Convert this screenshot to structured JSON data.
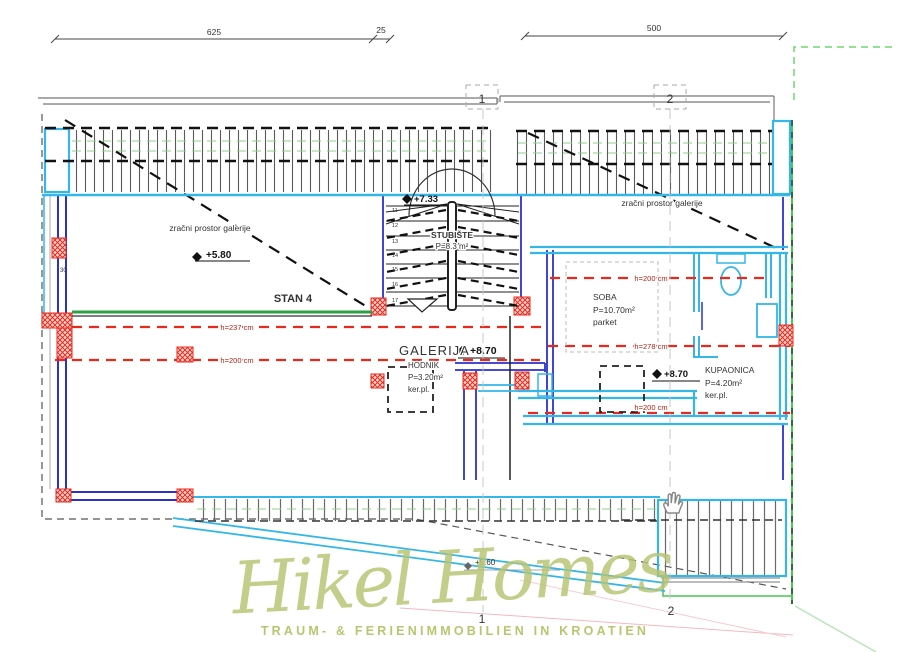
{
  "dimensions": {
    "left_main": "625",
    "left_small": "25",
    "right_main": "500",
    "wall_thickness": "30"
  },
  "grid": {
    "top_1": "1",
    "top_2": "2",
    "bottom_1": "1",
    "bottom_2": "2"
  },
  "levels": {
    "stair": "+7.33",
    "void": "+5.80",
    "gallery": "+8.70",
    "bath": "+8.70",
    "roof": "+9.60"
  },
  "annotations": {
    "void_left": "zračni prostor galerije",
    "void_right": "zračni prostor galerije",
    "apartment": "STAN 4"
  },
  "rooms": {
    "galerija": {
      "name": "GALERIJA"
    },
    "stubiste": {
      "name": "STUBIŠTE",
      "area": "P=8.3 m²"
    },
    "hodnik": {
      "name": "HODNIK",
      "area": "P=3.20m²",
      "floor": "ker.pl."
    },
    "soba": {
      "name": "SOBA",
      "area": "P=10.70m²",
      "floor": "parket"
    },
    "kupaonica": {
      "name": "KUPAONICA",
      "area": "P=4.20m²",
      "floor": "ker.pl."
    }
  },
  "heights": {
    "h237": "h=237 cm",
    "h200_left": "h=200 cm",
    "h200_right": "h=200 cm",
    "h278": "h=278 cm",
    "h200_bottom": "h=200 cm"
  },
  "stairs": {
    "numbers": [
      "11",
      "12",
      "13",
      "14",
      "15",
      "16",
      "17"
    ]
  },
  "watermark": {
    "brand": "Hikel Homes",
    "tagline": "TRAUM- & FERIENIMMOBILIEN IN KROATIEN"
  },
  "colors": {
    "cyan": "#35b6e8",
    "blue": "#2b32c8",
    "red": "#e8291c",
    "green": "#2f9e44",
    "boundary_green": "#5ecf63",
    "watermark_green": "#b6c472"
  }
}
